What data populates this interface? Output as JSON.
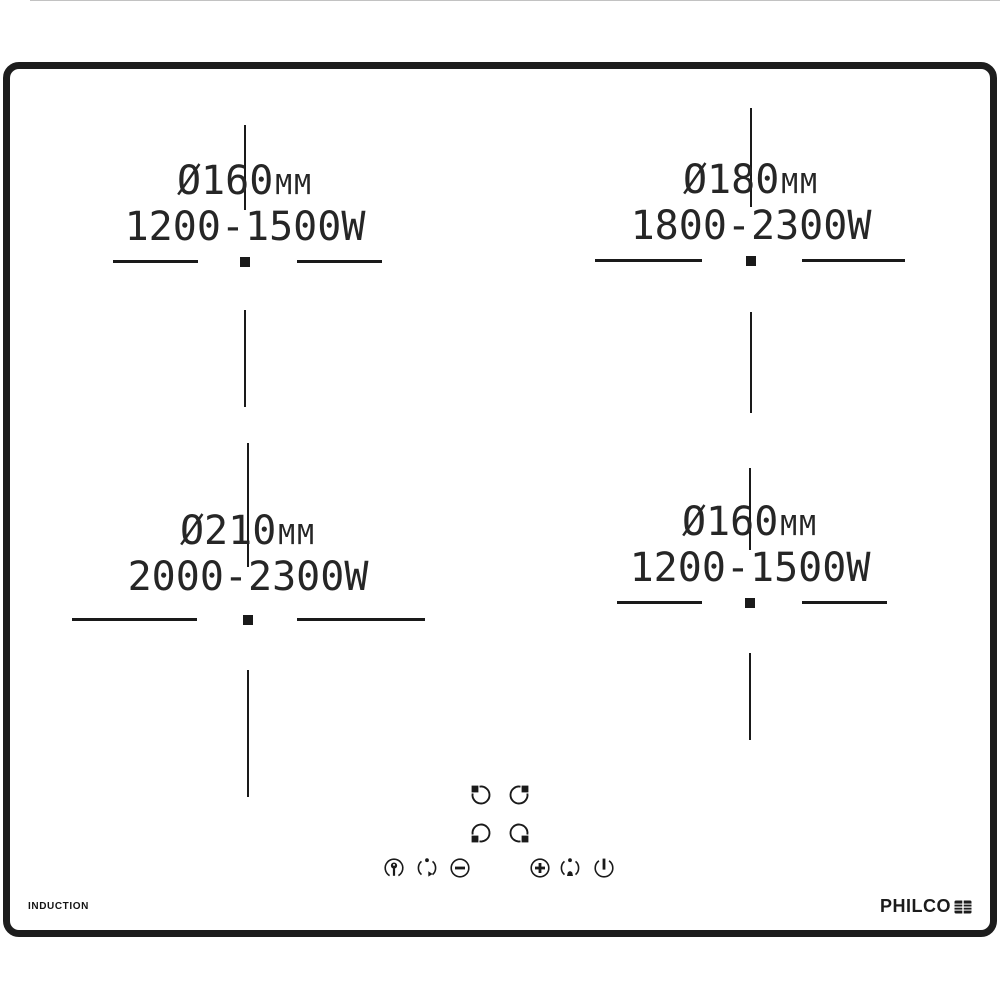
{
  "product": {
    "type_label": "INDUCTION",
    "brand": "PHILCO"
  },
  "zones": [
    {
      "name": "rear-left",
      "diameter": "Ø160",
      "unit": "mm",
      "power": "1200-1500W"
    },
    {
      "name": "rear-right",
      "diameter": "Ø180",
      "unit": "mm",
      "power": "1800-2300W"
    },
    {
      "name": "front-left",
      "diameter": "Ø210",
      "unit": "mm",
      "power": "2000-2300W"
    },
    {
      "name": "front-right",
      "diameter": "Ø160",
      "unit": "mm",
      "power": "1200-1500W"
    }
  ],
  "controls": {
    "zone_selector_icons": [
      "zone-rear-left-icon",
      "zone-rear-right-icon",
      "zone-front-left-icon",
      "zone-front-right-icon"
    ],
    "function_icons": [
      "child-lock-icon",
      "timer-icon",
      "minus-icon",
      "plus-icon",
      "booster-icon",
      "power-icon"
    ]
  },
  "colors": {
    "ink": "#1d1d1d",
    "background": "#ffffff"
  }
}
